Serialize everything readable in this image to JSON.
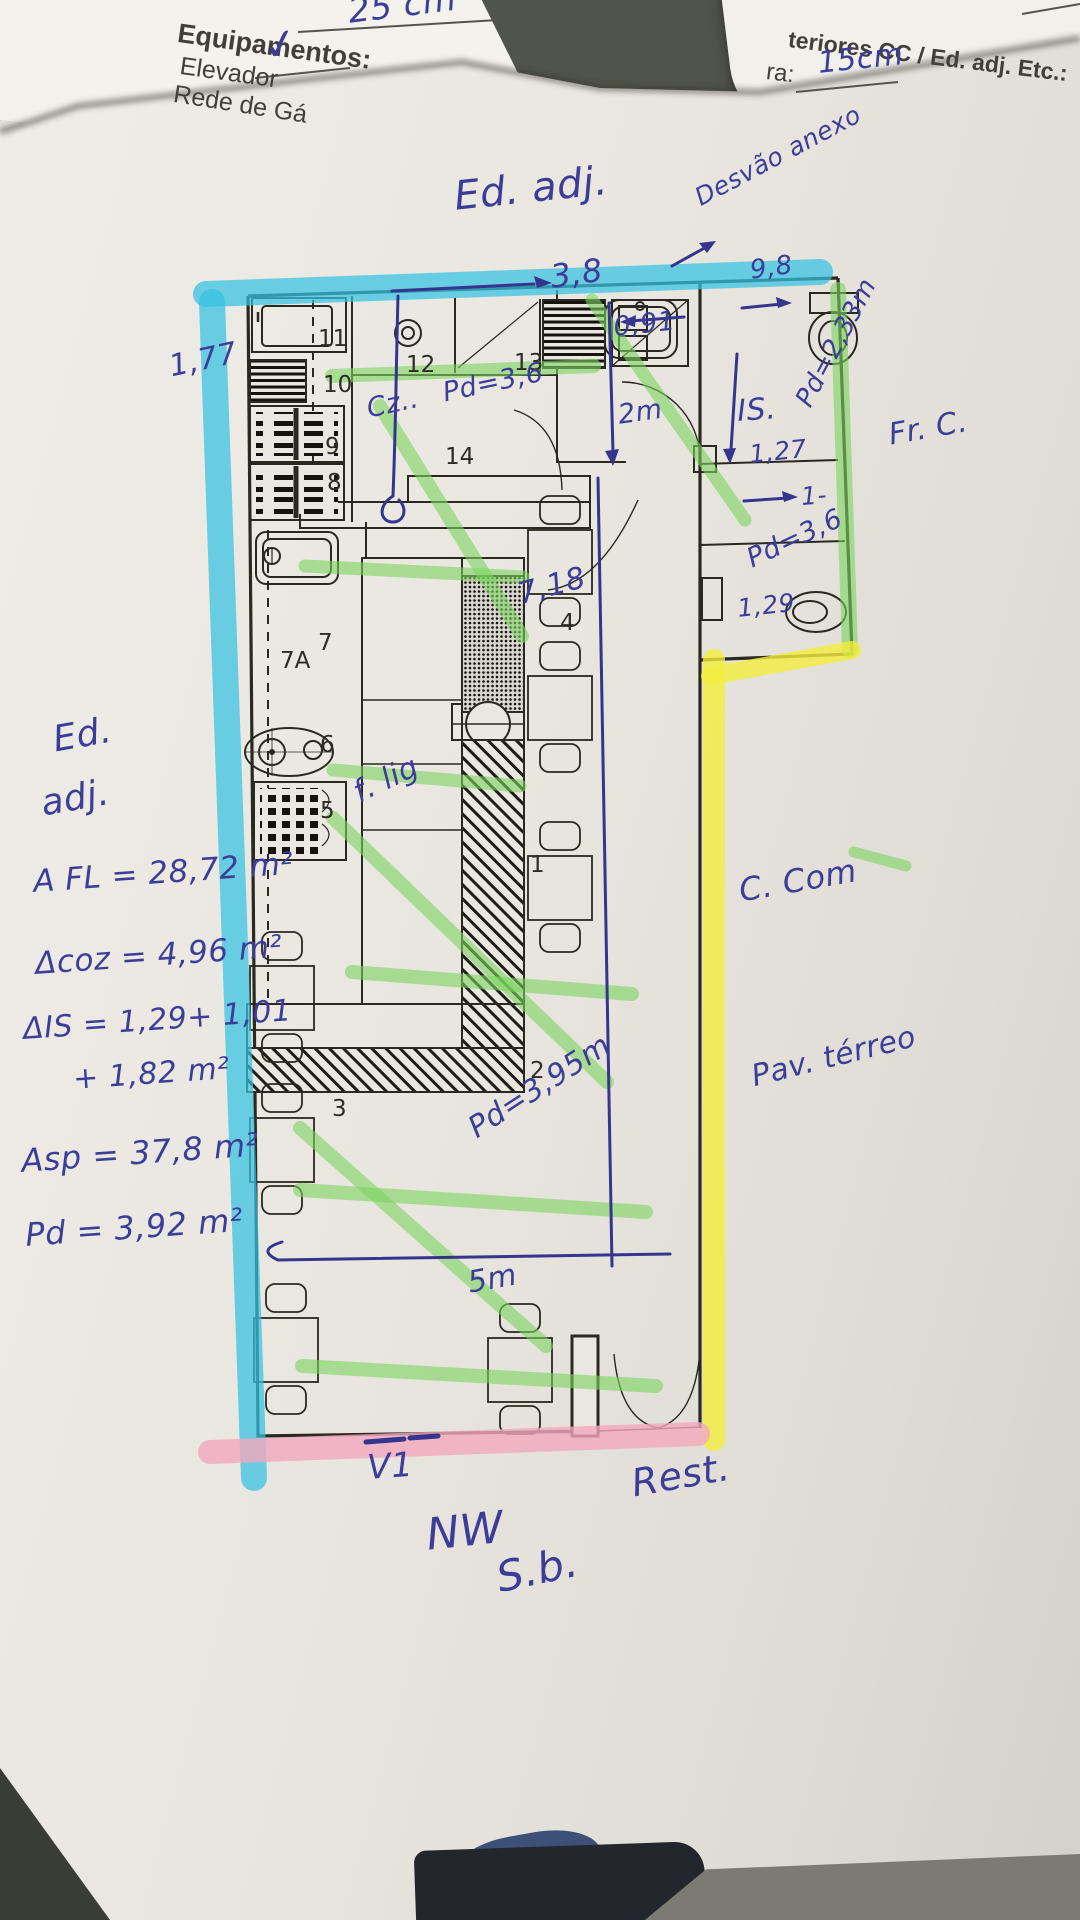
{
  "colors": {
    "paper": "#e8e6df",
    "background": "#51544a",
    "ink_blue": "#3d3d99",
    "plan_line": "#2a291f",
    "highlight_cyan": "#35c2e2",
    "highlight_green": "#7cd45f",
    "highlight_yellow": "#f2ee3c",
    "highlight_pink": "#f3a8bd"
  },
  "papers": {
    "left_form": {
      "title": "Equipamentos:",
      "item_elevador": "Elevador",
      "item_rede": "Rede de Gá",
      "checkmark": "✓",
      "measure_25": "25 cm"
    },
    "right_form": {
      "heading": "teriores CC / Ed. adj. Etc.:",
      "field_label": "ra:",
      "field_value": "15cm"
    }
  },
  "plan": {
    "room_numbers": {
      "n1": "1",
      "n2": "2",
      "n3": "3",
      "n4": "4",
      "n5": "5",
      "n6": "6",
      "n7": "7",
      "n7a": "7A",
      "n8": "8",
      "n9": "9",
      "n10": "10",
      "n11": "11",
      "n12": "12",
      "n13": "13",
      "n14": "14"
    },
    "measures": {
      "top_counter": "3,8",
      "sink": "0,91",
      "wc_width": "9,8",
      "wc_ceiling": "Pd=2,33m",
      "wc_room": "IS.",
      "wc_depth": "1,27",
      "hall": "2m",
      "kitchen": "Cz..",
      "kitchen_ceiling": "Pd=3,6",
      "hall_width": "1-",
      "hall_ceiling": "Pd=3,6",
      "bidet": "1,29",
      "room_length": "7,18",
      "left_wall": "1,77",
      "link": "f. lig",
      "dining_ceiling": "Pd=3,95m",
      "dining_width": "5m"
    }
  },
  "annotations": {
    "ed_adj_top": "Ed. adj.",
    "desvao": "Desvão anexo",
    "fr_c": "Fr. C.",
    "ed_left_line1": "Ed.",
    "ed_left_line2": "adj.",
    "area_fl": "A FL = 28,72 m²",
    "area_coz": "Δcoz = 4,96 m²",
    "area_is_line1": "ΔIS = 1,29+ 1,01",
    "area_is_line2": "+ 1,82 m²",
    "area_sp": "Asp = 37,8 m²",
    "area_pd": "Pd = 3,92 m²",
    "c_com": "C. Com",
    "pav_terreo": "Pav. térreo",
    "v1": "V1",
    "rest": "Rest.",
    "nw": "NW",
    "sb": "S.b."
  }
}
